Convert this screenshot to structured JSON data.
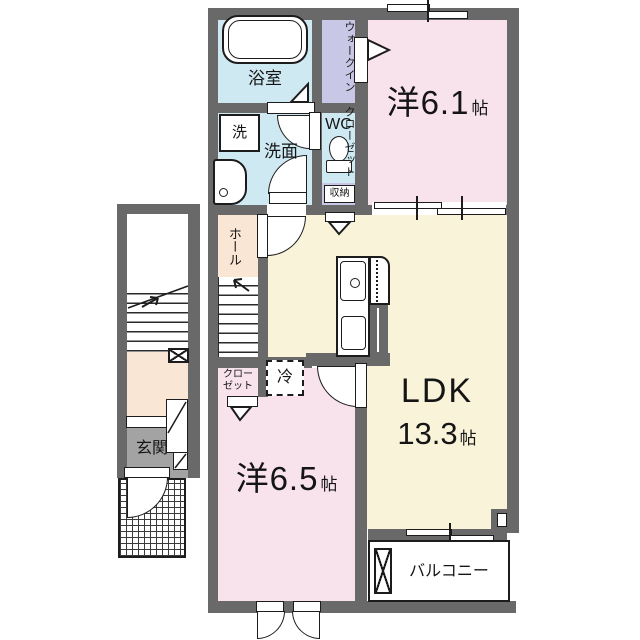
{
  "title": "apartment-floor-plan",
  "rooms": {
    "bathroom": {
      "label": "浴室"
    },
    "wic": {
      "line1": "ウォークイン",
      "line2": "クローゼット"
    },
    "washer": {
      "label": "洗"
    },
    "washroom": {
      "label": "洗面"
    },
    "wc": {
      "label": "WC"
    },
    "storage": {
      "label": "収納"
    },
    "hall": {
      "label": "ホール"
    },
    "bedroom1": {
      "name": "洋6.1",
      "unit": "帖"
    },
    "ldk": {
      "name": "LDK",
      "size": "13.3",
      "unit": "帖"
    },
    "closet": {
      "line1": "クロー",
      "line2": "ゼット"
    },
    "fridge": {
      "label": "冷"
    },
    "bedroom2": {
      "name": "洋6.5",
      "unit": "帖"
    },
    "entrance": {
      "label": "玄関"
    },
    "balcony": {
      "label": "バルコニー"
    }
  },
  "colors": {
    "wall": "#696969",
    "western_room": "#f8e3ed",
    "ldk": "#f9f3da",
    "wet_area": "#cfe9f3",
    "closet": "#c8c7e6",
    "hall": "#fae6d5",
    "entrance_floor": "#a3a3a3"
  }
}
